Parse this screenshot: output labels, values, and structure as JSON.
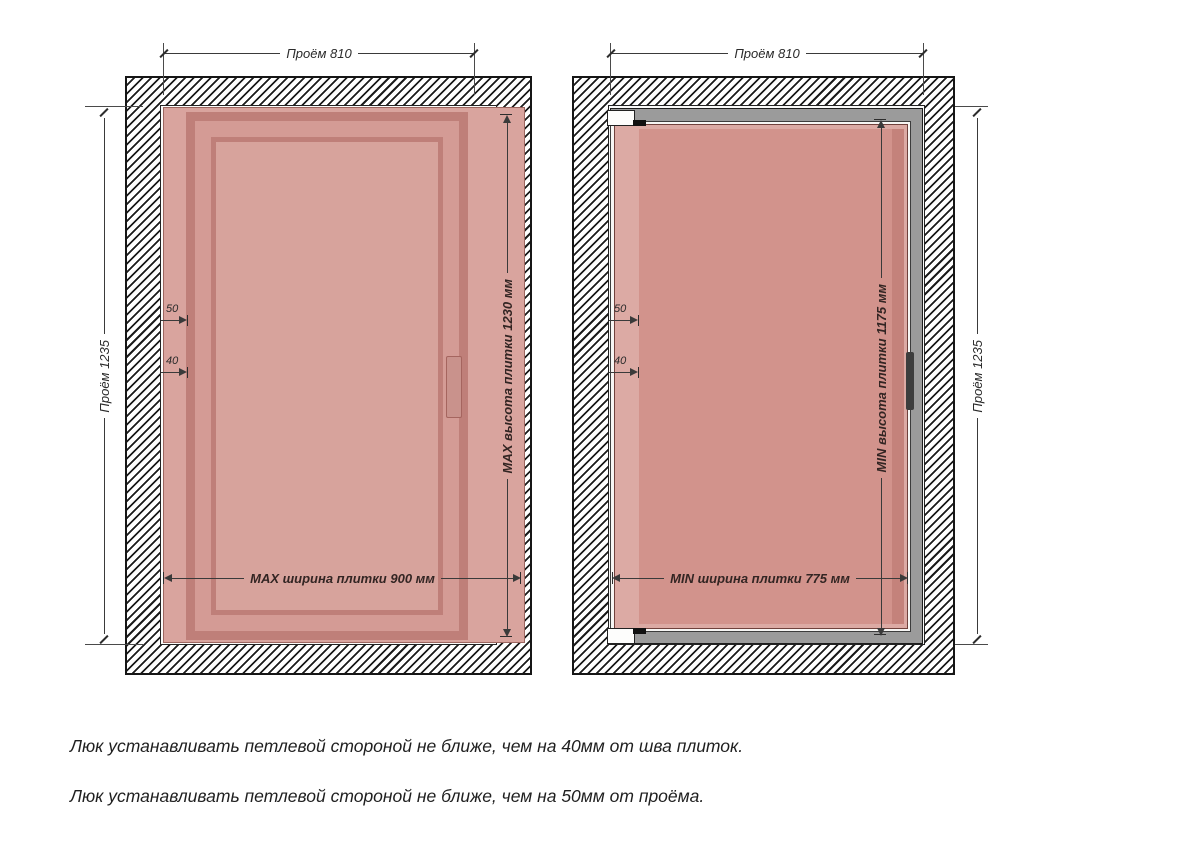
{
  "left_diagram": {
    "top_dim": "Проём 810",
    "side_dim": "Проём 1235",
    "height_dim": "MAX высота плитки 1230 мм",
    "width_dim": "MAX ширина плитки 900 мм",
    "offset_opening": "50",
    "offset_seam": "40"
  },
  "right_diagram": {
    "top_dim": "Проём 810",
    "side_dim": "Проём 1235",
    "height_dim": "MIN высота плитки 1175 мм",
    "width_dim": "MIN ширина плитки 775 мм",
    "offset_opening": "50",
    "offset_seam": "40"
  },
  "notes": [
    "Люк устанавливать петлевой стороной не ближе, чем на 40мм от шва плиток.",
    "Люк устанавливать петлевой стороной не ближе, чем на 50мм от проёма."
  ],
  "colors": {
    "tile_light": "#d9a49e",
    "tile_band_light": "#dcaaa4",
    "tile_mid": "#d2938c",
    "tile_dark_edge": "#c4827b",
    "leaf_frame": "#bf7f79",
    "leaf_channel": "#d49b95",
    "leaf_panel": "#d7a39c",
    "door_frame_gray": "#9b9b9b",
    "hatch_line": "#1b1b1b",
    "dim_line": "#3a3a3a",
    "text": "#2b2b2b"
  }
}
